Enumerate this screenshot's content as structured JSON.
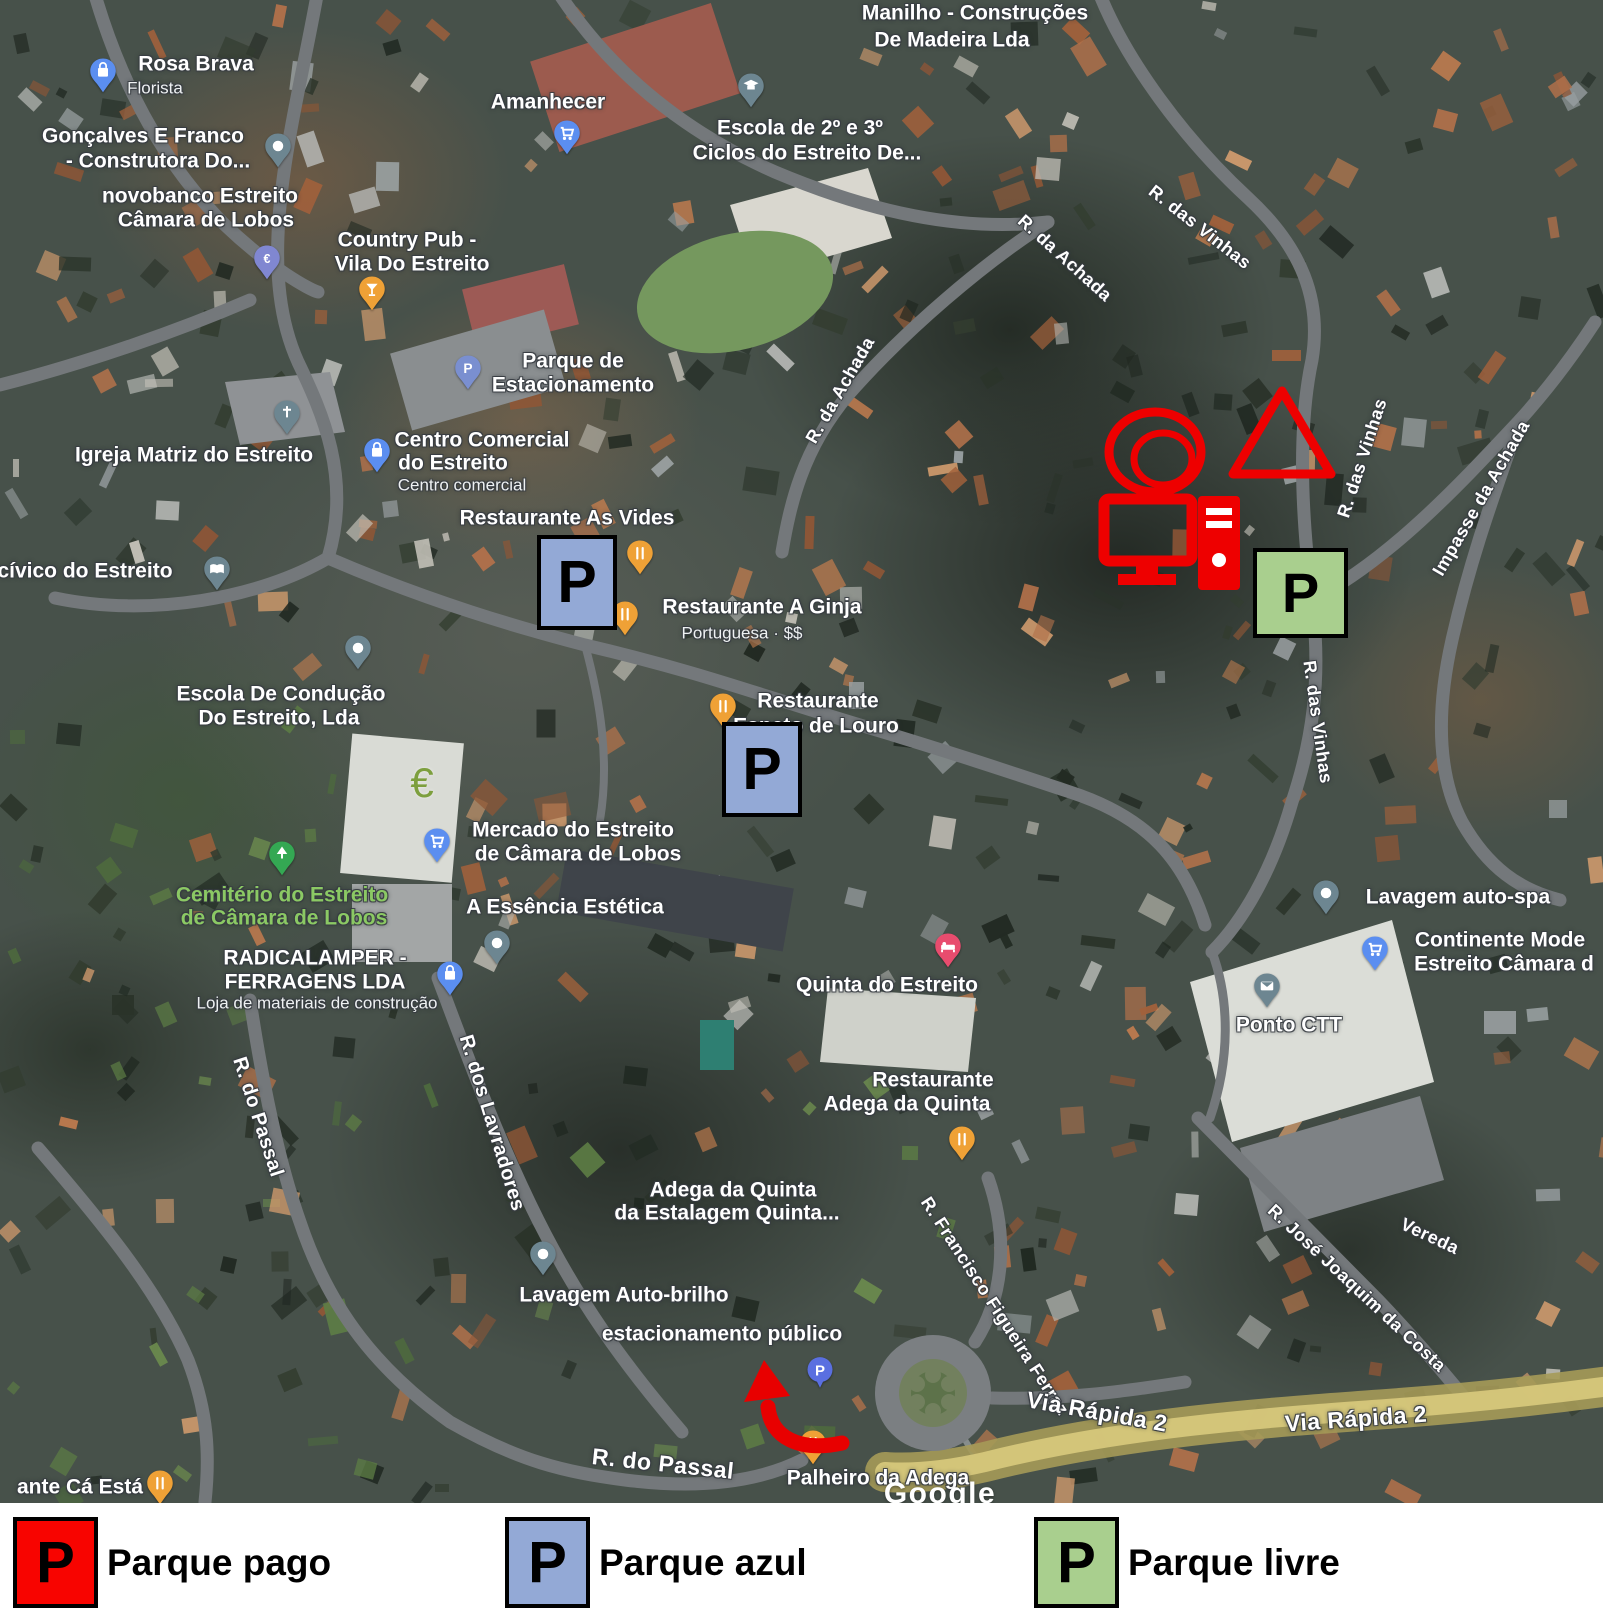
{
  "colors": {
    "parking_red": "#f80400",
    "parking_blue": "#93a9d6",
    "parking_green": "#a9cf8e",
    "annotation_red": "#ee0000"
  },
  "legend": {
    "items": [
      {
        "letter": "P",
        "variant": "red",
        "label": "Parque pago"
      },
      {
        "letter": "P",
        "variant": "blue",
        "label": "Parque azul"
      },
      {
        "letter": "P",
        "variant": "green",
        "label": "Parque livre"
      }
    ]
  },
  "parking_boxes": [
    {
      "letter": "P",
      "variant": "blue",
      "x": 537,
      "y": 535,
      "w": 80,
      "h": 95
    },
    {
      "letter": "P",
      "variant": "blue",
      "x": 722,
      "y": 722,
      "w": 80,
      "h": 95
    },
    {
      "letter": "P",
      "variant": "green",
      "x": 1253,
      "y": 548,
      "w": 95,
      "h": 90
    }
  ],
  "annotations": {
    "icons": [
      {
        "name": "double-circle"
      },
      {
        "name": "triangle"
      },
      {
        "name": "computer"
      }
    ],
    "arrow": {
      "name": "route-arrow"
    }
  },
  "map": {
    "labels": [
      {
        "t": "Manilho - Construções",
        "x": 975,
        "y": 13,
        "fs": 21
      },
      {
        "t": "De Madeira Lda",
        "x": 952,
        "y": 40,
        "fs": 21
      },
      {
        "t": "Rosa Brava",
        "x": 196,
        "y": 64,
        "fs": 21
      },
      {
        "t": "Florista",
        "x": 155,
        "y": 88,
        "fs": 17,
        "cls": "sub"
      },
      {
        "t": "Gonçalves E Franco",
        "x": 143,
        "y": 136,
        "fs": 21
      },
      {
        "t": "- Construtora Do...",
        "x": 158,
        "y": 161,
        "fs": 21
      },
      {
        "t": "novobanco Estreito",
        "x": 200,
        "y": 196,
        "fs": 21
      },
      {
        "t": "Câmara de Lobos",
        "x": 206,
        "y": 220,
        "fs": 21
      },
      {
        "t": "Amanhecer",
        "x": 548,
        "y": 102,
        "fs": 21
      },
      {
        "t": "Country Pub -",
        "x": 407,
        "y": 240,
        "fs": 21
      },
      {
        "t": "Vila Do Estreito",
        "x": 412,
        "y": 264,
        "fs": 21
      },
      {
        "t": "Escola de 2º e 3º",
        "x": 800,
        "y": 128,
        "fs": 21
      },
      {
        "t": "Ciclos do Estreito De...",
        "x": 807,
        "y": 153,
        "fs": 21
      },
      {
        "t": "R. das Vinhas",
        "x": 1200,
        "y": 227,
        "fs": 18,
        "rot": 38,
        "cls": "road"
      },
      {
        "t": "R. da Achada",
        "x": 1065,
        "y": 258,
        "fs": 18,
        "rot": 42,
        "cls": "road"
      },
      {
        "t": "R. da Achada",
        "x": 840,
        "y": 390,
        "fs": 18,
        "rot": -60,
        "cls": "road"
      },
      {
        "t": "Parque de",
        "x": 573,
        "y": 361,
        "fs": 21
      },
      {
        "t": "Estacionamento",
        "x": 573,
        "y": 385,
        "fs": 21
      },
      {
        "t": "Centro Comercial",
        "x": 482,
        "y": 440,
        "fs": 21
      },
      {
        "t": "do Estreito",
        "x": 453,
        "y": 463,
        "fs": 21
      },
      {
        "t": "Centro comercial",
        "x": 462,
        "y": 485,
        "fs": 17,
        "cls": "sub"
      },
      {
        "t": "Restaurante As Vides",
        "x": 567,
        "y": 518,
        "fs": 21
      },
      {
        "t": "Restaurante A Ginja",
        "x": 762,
        "y": 607,
        "fs": 21
      },
      {
        "t": "Portuguesa · $$",
        "x": 742,
        "y": 633,
        "fs": 17,
        "cls": "sub"
      },
      {
        "t": "Igreja Matriz do Estreito",
        "x": 194,
        "y": 455,
        "fs": 21
      },
      {
        "t": "cívico do Estreito",
        "x": 85,
        "y": 571,
        "fs": 21
      },
      {
        "t": "Escola De Condução",
        "x": 281,
        "y": 694,
        "fs": 21
      },
      {
        "t": "Do Estreito, Lda",
        "x": 279,
        "y": 718,
        "fs": 21
      },
      {
        "t": "Restaurante",
        "x": 818,
        "y": 701,
        "fs": 21
      },
      {
        "t": "Espeto de Louro",
        "x": 816,
        "y": 726,
        "fs": 21
      },
      {
        "t": "€",
        "x": 422,
        "y": 783,
        "fs": 42,
        "cls": "euro"
      },
      {
        "t": "Mercado do Estreito",
        "x": 573,
        "y": 830,
        "fs": 21
      },
      {
        "t": "de Câmara de Lobos",
        "x": 578,
        "y": 854,
        "fs": 21
      },
      {
        "t": "Cemitério do Estreito",
        "x": 282,
        "y": 895,
        "fs": 21,
        "cls": "green"
      },
      {
        "t": "de Câmara de Lobos",
        "x": 284,
        "y": 918,
        "fs": 21,
        "cls": "green"
      },
      {
        "t": "A Essência Estética",
        "x": 565,
        "y": 907,
        "fs": 21
      },
      {
        "t": "RADICALAMPER -",
        "x": 315,
        "y": 958,
        "fs": 21
      },
      {
        "t": "FERRAGENS LDA",
        "x": 315,
        "y": 982,
        "fs": 21
      },
      {
        "t": "Loja de materiais de construção",
        "x": 317,
        "y": 1003,
        "fs": 17,
        "cls": "sub"
      },
      {
        "t": "R. do Passal",
        "x": 258,
        "y": 1117,
        "fs": 20,
        "rot": 72,
        "cls": "road"
      },
      {
        "t": "R. dos Lavradores",
        "x": 492,
        "y": 1123,
        "fs": 20,
        "rot": 73,
        "cls": "road"
      },
      {
        "t": "Quinta do Estreito",
        "x": 887,
        "y": 985,
        "fs": 21
      },
      {
        "t": "Restaurante",
        "x": 933,
        "y": 1080,
        "fs": 21
      },
      {
        "t": "Adega da Quinta",
        "x": 907,
        "y": 1104,
        "fs": 21
      },
      {
        "t": "Lavagem auto-spa",
        "x": 1458,
        "y": 897,
        "fs": 21
      },
      {
        "t": "Continente Mode",
        "x": 1500,
        "y": 940,
        "fs": 21
      },
      {
        "t": "Estreito Câmara d",
        "x": 1504,
        "y": 964,
        "fs": 21
      },
      {
        "t": "Ponto CTT",
        "x": 1289,
        "y": 1025,
        "fs": 21
      },
      {
        "t": "Adega da Quinta",
        "x": 733,
        "y": 1190,
        "fs": 21
      },
      {
        "t": "da Estalagem Quinta...",
        "x": 727,
        "y": 1213,
        "fs": 21
      },
      {
        "t": "Lavagem Auto-brilho",
        "x": 624,
        "y": 1295,
        "fs": 21
      },
      {
        "t": "estacionamento público",
        "x": 722,
        "y": 1334,
        "fs": 21
      },
      {
        "t": "R. do Passal",
        "x": 663,
        "y": 1464,
        "fs": 23,
        "rot": 6,
        "cls": "road"
      },
      {
        "t": "Palheiro da Adega",
        "x": 878,
        "y": 1478,
        "fs": 21
      },
      {
        "t": "R. Francisco Figueira Ferraz",
        "x": 995,
        "y": 1306,
        "fs": 18,
        "rot": 57,
        "cls": "road"
      },
      {
        "t": "Via Rápida 2",
        "x": 1097,
        "y": 1412,
        "fs": 23,
        "rot": 10,
        "cls": "road"
      },
      {
        "t": "Via Rápida 2",
        "x": 1356,
        "y": 1419,
        "fs": 23,
        "rot": -4,
        "cls": "road"
      },
      {
        "t": "R. José Joaquim da Costa",
        "x": 1357,
        "y": 1288,
        "fs": 18,
        "rot": 43,
        "cls": "road"
      },
      {
        "t": "Vereda",
        "x": 1430,
        "y": 1236,
        "fs": 18,
        "rot": 25,
        "cls": "road"
      },
      {
        "t": "R. das Vinhas",
        "x": 1362,
        "y": 458,
        "fs": 18,
        "rot": -72,
        "cls": "road"
      },
      {
        "t": "Impasse da Achada",
        "x": 1481,
        "y": 498,
        "fs": 18,
        "rot": -60,
        "cls": "road"
      },
      {
        "t": "R. das Vinhas",
        "x": 1318,
        "y": 722,
        "fs": 18,
        "rot": 82,
        "cls": "road"
      },
      {
        "t": "ante Cá Está",
        "x": 80,
        "y": 1487,
        "fs": 21
      },
      {
        "t": "Google",
        "x": 940,
        "y": 1494,
        "fs": 30,
        "cls": "watermark"
      }
    ],
    "pins": [
      {
        "g": "bag",
        "c": "#5b8ef0",
        "x": 103,
        "y": 70
      },
      {
        "g": "dot",
        "c": "#6d8691",
        "x": 278,
        "y": 145
      },
      {
        "g": "euro",
        "c": "#8087d1",
        "x": 267,
        "y": 257
      },
      {
        "g": "cart",
        "c": "#5b8ef0",
        "x": 567,
        "y": 132
      },
      {
        "g": "school",
        "c": "#6d8691",
        "x": 751,
        "y": 85
      },
      {
        "g": "glass",
        "c": "#efa136",
        "x": 372,
        "y": 288
      },
      {
        "g": "P",
        "c": "#7a8fd0",
        "x": 468,
        "y": 367
      },
      {
        "g": "bag",
        "c": "#5b8ef0",
        "x": 377,
        "y": 450
      },
      {
        "g": "fork",
        "c": "#efa136",
        "x": 640,
        "y": 552
      },
      {
        "g": "fork",
        "c": "#efa136",
        "x": 625,
        "y": 613
      },
      {
        "g": "church",
        "c": "#6d8691",
        "x": 287,
        "y": 412
      },
      {
        "g": "book",
        "c": "#6d8691",
        "x": 217,
        "y": 568
      },
      {
        "g": "dot",
        "c": "#6d8691",
        "x": 358,
        "y": 647
      },
      {
        "g": "fork",
        "c": "#efa136",
        "x": 723,
        "y": 705
      },
      {
        "g": "cart",
        "c": "#5b8ef0",
        "x": 437,
        "y": 840
      },
      {
        "g": "tree",
        "c": "#34a853",
        "x": 282,
        "y": 853
      },
      {
        "g": "dot",
        "c": "#6d8691",
        "x": 497,
        "y": 942
      },
      {
        "g": "bag",
        "c": "#5b8ef0",
        "x": 450,
        "y": 973
      },
      {
        "g": "bed",
        "c": "#e84c6e",
        "x": 948,
        "y": 945
      },
      {
        "g": "fork",
        "c": "#efa136",
        "x": 962,
        "y": 1138
      },
      {
        "g": "dot",
        "c": "#6d8691",
        "x": 1326,
        "y": 892
      },
      {
        "g": "cart",
        "c": "#5b8ef0",
        "x": 1375,
        "y": 948
      },
      {
        "g": "mail",
        "c": "#6d8691",
        "x": 1267,
        "y": 985
      },
      {
        "g": "dot",
        "c": "#6d8691",
        "x": 543,
        "y": 1253
      },
      {
        "g": "circleP",
        "c": "#5a6fe0",
        "x": 820,
        "y": 1368
      },
      {
        "g": "fork",
        "c": "#efa136",
        "x": 813,
        "y": 1442
      },
      {
        "g": "fork",
        "c": "#efa136",
        "x": 160,
        "y": 1482
      }
    ]
  }
}
